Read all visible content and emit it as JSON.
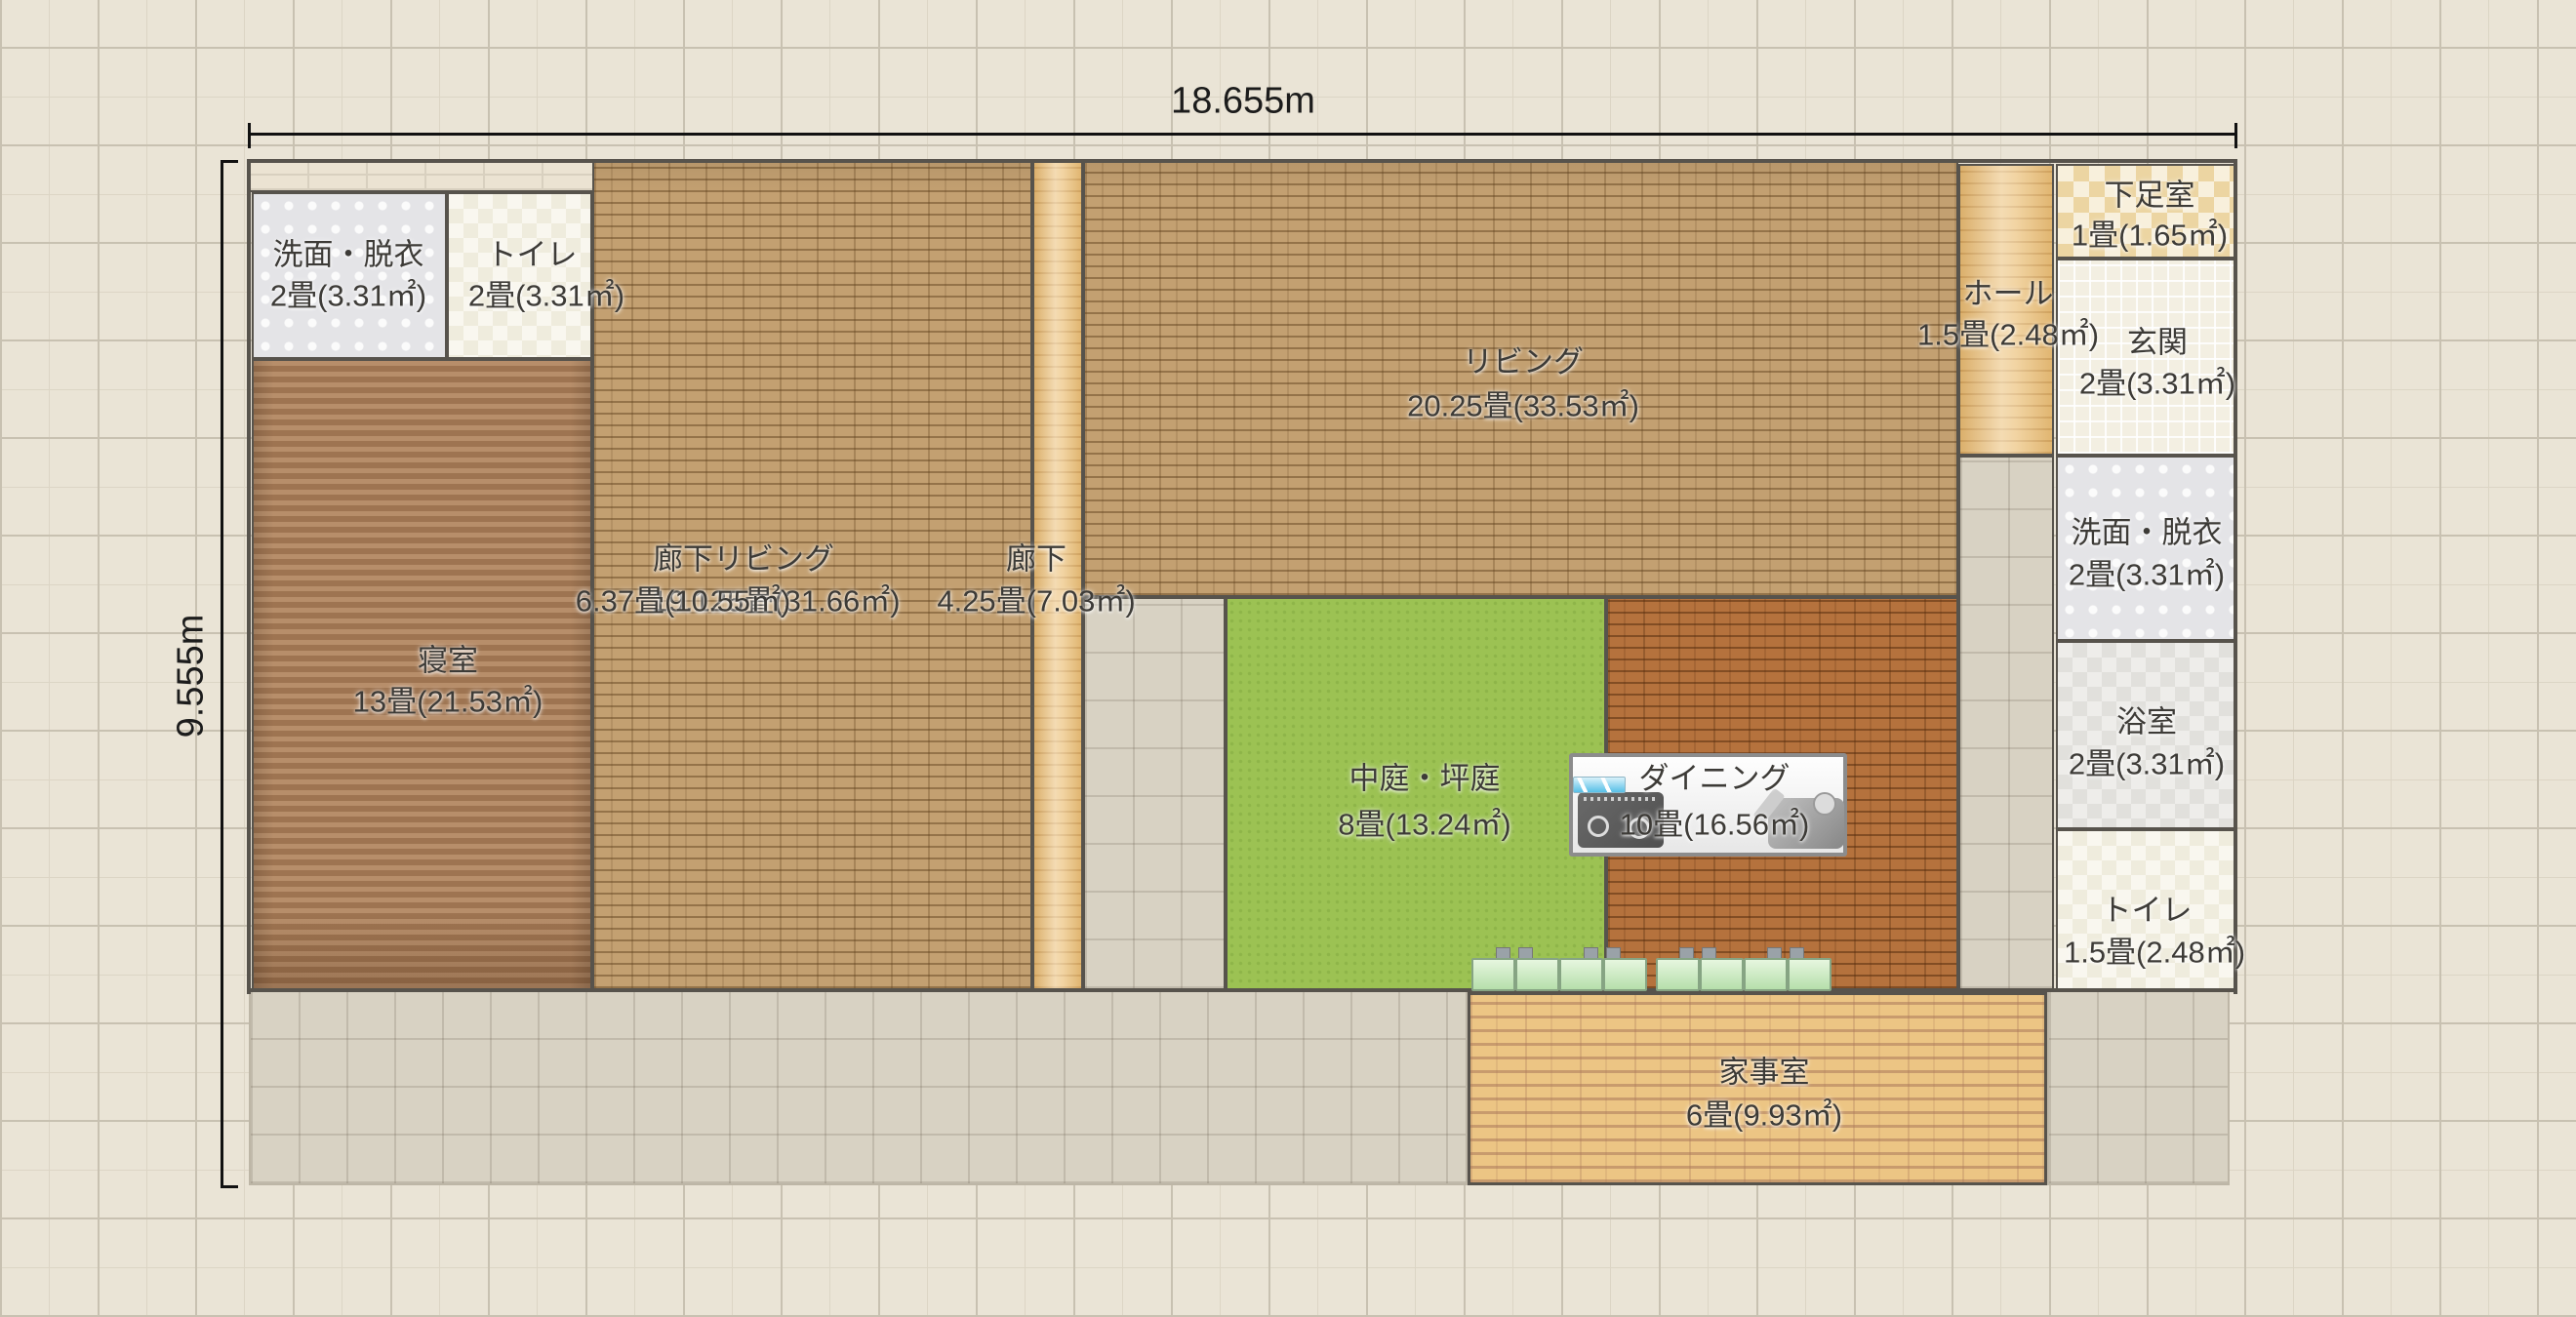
{
  "app": {
    "view": "floorplan-editor-canvas"
  },
  "dimensions": {
    "width_label": "18.655m",
    "height_label": "9.555m"
  },
  "rooms": {
    "washroom_top": {
      "name": "洗面・脱衣",
      "area": "2畳(3.31㎡)",
      "floor": "gray-dot-tile"
    },
    "toilet_top": {
      "name": "トイレ",
      "area": "2畳(3.31㎡)",
      "floor": "cream-checker"
    },
    "bedroom": {
      "name": "寝室",
      "area": "13畳(21.53㎡)",
      "floor": "brown-wood"
    },
    "corridor_living": {
      "name": "廊下リビング",
      "area": "19.125畳(31.66㎡)",
      "floor": "light-brick"
    },
    "unnamed_mid": {
      "name": "",
      "area": "6.37畳(10.55㎡)",
      "floor": "light-brick"
    },
    "corridor": {
      "name": "廊下",
      "area": "4.25畳(7.03㎡)",
      "floor": "tan-wood"
    },
    "living": {
      "name": "リビング",
      "area": "20.25畳(33.53㎡)",
      "floor": "light-brick"
    },
    "courtyard": {
      "name": "中庭・坪庭",
      "area": "8畳(13.24㎡)",
      "floor": "green-garden"
    },
    "dining": {
      "name": "ダイニング",
      "area": "10畳(16.56㎡)",
      "floor": "dark-brick"
    },
    "hall": {
      "name": "ホール",
      "area": "1.5畳(2.48㎡)",
      "floor": "tan-wood"
    },
    "shoe_room": {
      "name": "下足室",
      "area": "1畳(1.65㎡)",
      "floor": "tan-checker"
    },
    "entrance": {
      "name": "玄関",
      "area": "2畳(3.31㎡)",
      "floor": "small-white-tile"
    },
    "washroom_right": {
      "name": "洗面・脱衣",
      "area": "2畳(3.31㎡)",
      "floor": "gray-dot-tile"
    },
    "bathroom": {
      "name": "浴室",
      "area": "2畳(3.31㎡)",
      "floor": "bath-checker"
    },
    "toilet_right": {
      "name": "トイレ",
      "area": "1.5畳(2.48㎡)",
      "floor": "cream-checker"
    },
    "utility": {
      "name": "家事室",
      "area": "6畳(9.93㎡)",
      "floor": "tan-brick"
    }
  },
  "fixtures": {
    "kitchen_panel": {
      "icons": [
        "stove-icon",
        "camera-icon",
        "sink-glass-icon"
      ],
      "storage_box_count": 8
    }
  },
  "colors": {
    "background": "#eae4d6",
    "grid_minor": "#dcd5c5",
    "grid_major": "#c8c1b1",
    "wall": "#57534c",
    "courtyard_green": "#9cc253",
    "living_brick": "#c3a071",
    "dining_brick": "#b5723d",
    "bedroom_wood": "#a97e5a",
    "corridor_wood": "#ecc27c",
    "terrace_tile": "#d8d2c3",
    "utility_brick": "#ecc584",
    "label_text": "#3d3b37"
  }
}
